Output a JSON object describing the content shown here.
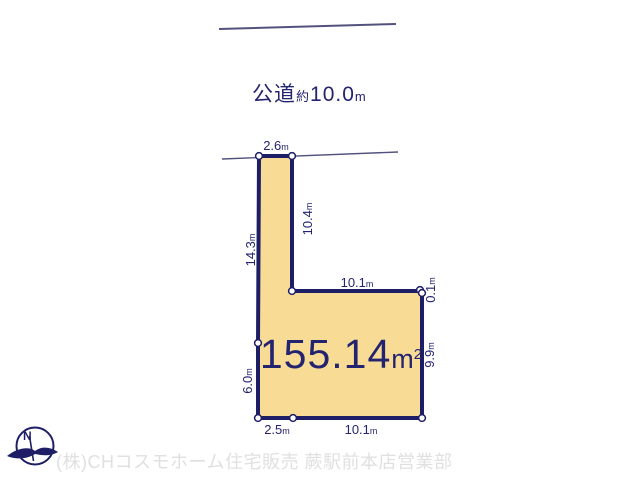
{
  "colors": {
    "plot_fill": "#f8dc96",
    "plot_outline": "#1e1e66",
    "label_navy": "#232370",
    "thin_line": "#52527f",
    "footer_gray": "#e0e0e0"
  },
  "road": {
    "name_label": "公道",
    "approx_label": "約",
    "width_value": "10.0",
    "unit": "m"
  },
  "plot": {
    "area": {
      "value": "155.14",
      "unit": "m",
      "sup": "2"
    },
    "dimensions": [
      {
        "value": "2.6",
        "unit": "m"
      },
      {
        "value": "14.3",
        "unit": "m"
      },
      {
        "value": "10.4",
        "unit": "m"
      },
      {
        "value": "10.1",
        "unit": "m"
      },
      {
        "value": "0.1",
        "unit": "m"
      },
      {
        "value": "9.9",
        "unit": "m"
      },
      {
        "value": "6.0",
        "unit": "m"
      },
      {
        "value": "2.5",
        "unit": "m"
      },
      {
        "value": "10.1",
        "unit": "m"
      }
    ]
  },
  "compass": {
    "north_label": "N"
  },
  "footer": {
    "company": "(株)CHコスモホーム住宅販売 蕨駅前本店営業部"
  }
}
